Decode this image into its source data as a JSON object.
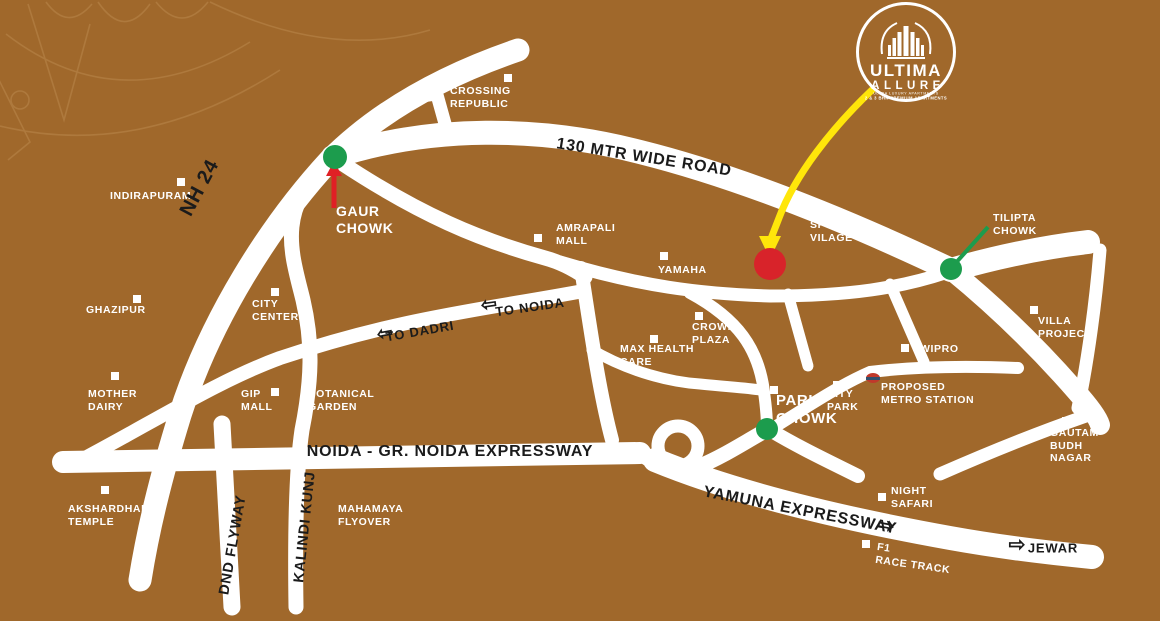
{
  "colors": {
    "background": "#A0682B",
    "road": "#FFFFFF",
    "label_white": "#FFFFFF",
    "label_black": "#1B1B1B",
    "dot_green": "#1C9C4D",
    "dot_red": "#D8232A",
    "pointer_yellow": "#FFE60A",
    "pointer_red": "#E02025"
  },
  "logo": {
    "name": "ULTIMA",
    "sub": "ALLURE",
    "tagline1": "ULTRA LUXURY APARTMENTS",
    "tagline2": "2 & 3 BHK PREMIUM APARTMENTS"
  },
  "landmarks": [
    {
      "id": "crossing-republic",
      "lines": [
        "CROSSING",
        "REPUBLIC"
      ],
      "x": 450,
      "y": 85,
      "marker": {
        "x": 508,
        "y": 78
      }
    },
    {
      "id": "indirapuram",
      "lines": [
        "INDIRAPURAM"
      ],
      "x": 110,
      "y": 190,
      "marker": {
        "x": 181,
        "y": 182
      }
    },
    {
      "id": "gaur-chowk",
      "lines": [
        "GAUR",
        "CHOWK"
      ],
      "x": 336,
      "y": 203,
      "size": 14
    },
    {
      "id": "amrapali-mall",
      "lines": [
        "AMRAPALI",
        "MALL"
      ],
      "x": 556,
      "y": 222,
      "marker": {
        "x": 538,
        "y": 238
      }
    },
    {
      "id": "yamaha",
      "lines": [
        "YAMAHA"
      ],
      "x": 658,
      "y": 264,
      "marker": {
        "x": 664,
        "y": 256
      }
    },
    {
      "id": "sports-vilage",
      "lines": [
        "SPORTS",
        "VILAGE"
      ],
      "x": 810,
      "y": 219,
      "marker": {
        "x": 813,
        "y": 212
      }
    },
    {
      "id": "tilipta-chowk",
      "lines": [
        "TILIPTA",
        "CHOWK"
      ],
      "x": 993,
      "y": 212
    },
    {
      "id": "ghazipur",
      "lines": [
        "GHAZIPUR"
      ],
      "x": 86,
      "y": 304,
      "marker": {
        "x": 137,
        "y": 299
      }
    },
    {
      "id": "city-center",
      "lines": [
        "CITY",
        "CENTER"
      ],
      "x": 252,
      "y": 298,
      "marker": {
        "x": 275,
        "y": 292
      }
    },
    {
      "id": "crown-plaza",
      "lines": [
        "CROWN",
        "PLAZA"
      ],
      "x": 692,
      "y": 321,
      "marker": {
        "x": 699,
        "y": 316
      }
    },
    {
      "id": "max-health-care",
      "lines": [
        "MAX HEALTH",
        "CARE"
      ],
      "x": 620,
      "y": 343,
      "marker": {
        "x": 654,
        "y": 339
      }
    },
    {
      "id": "villa-project",
      "lines": [
        "VILLA",
        "PROJECT"
      ],
      "x": 1038,
      "y": 315,
      "marker": {
        "x": 1034,
        "y": 310
      }
    },
    {
      "id": "wipro",
      "lines": [
        "WIPRO"
      ],
      "x": 920,
      "y": 343,
      "marker": {
        "x": 905,
        "y": 348
      }
    },
    {
      "id": "mother-dairy",
      "lines": [
        "MOTHER",
        "DAIRY"
      ],
      "x": 88,
      "y": 388,
      "marker": {
        "x": 115,
        "y": 376
      }
    },
    {
      "id": "gip-mall",
      "lines": [
        "GIP",
        "MALL"
      ],
      "x": 241,
      "y": 388,
      "marker": {
        "x": 275,
        "y": 392
      }
    },
    {
      "id": "botanical-garden",
      "lines": [
        "BOTANICAL",
        "GARDEN"
      ],
      "x": 308,
      "y": 388
    },
    {
      "id": "pari-chowk",
      "lines": [
        "PARI",
        "CHOWK"
      ],
      "x": 776,
      "y": 392,
      "size": 15,
      "marker": {
        "x": 774,
        "y": 390
      }
    },
    {
      "id": "city-park",
      "lines": [
        "CITY",
        "PARK"
      ],
      "x": 827,
      "y": 388,
      "marker": {
        "x": 837,
        "y": 385
      }
    },
    {
      "id": "proposed-metro-station",
      "lines": [
        "PROPOSED",
        "METRO STATION"
      ],
      "x": 881,
      "y": 381,
      "metro": {
        "x": 873,
        "y": 378
      }
    },
    {
      "id": "gautam-budh-nagar",
      "lines": [
        "GAUTAM",
        "BUDH",
        "NAGAR"
      ],
      "x": 1050,
      "y": 427,
      "marker": {
        "x": 1066,
        "y": 421
      }
    },
    {
      "id": "night-safari",
      "lines": [
        "NIGHT",
        "SAFARI"
      ],
      "x": 891,
      "y": 485,
      "marker": {
        "x": 882,
        "y": 497
      }
    },
    {
      "id": "f1-race-track",
      "lines": [
        "F1",
        "RACE TRACK"
      ],
      "x": 878,
      "y": 541,
      "rotate": 8,
      "marker": {
        "x": 866,
        "y": 544
      }
    },
    {
      "id": "mahamaya-flyover",
      "lines": [
        "MAHAMAYA",
        "FLYOVER"
      ],
      "x": 338,
      "y": 503
    },
    {
      "id": "akshardham-temple",
      "lines": [
        "AKSHARDHAM",
        "TEMPLE"
      ],
      "x": 68,
      "y": 503,
      "marker": {
        "x": 105,
        "y": 490
      }
    }
  ],
  "road_labels": [
    {
      "id": "nh-24",
      "text": "NH 24",
      "x": 200,
      "y": 188,
      "rotate": -62,
      "size": 20
    },
    {
      "id": "130-mtr-wide-road",
      "text": "130 MTR WIDE ROAD",
      "x": 644,
      "y": 158,
      "rotate": 9,
      "size": 16
    },
    {
      "id": "to-noida",
      "text": "TO NOIDA",
      "x": 530,
      "y": 307,
      "rotate": -8,
      "size": 13
    },
    {
      "id": "to-dadri",
      "text": "TO DADRI",
      "x": 420,
      "y": 331,
      "rotate": -10,
      "size": 13
    },
    {
      "id": "noida-gr-noida-expressway",
      "text": "NOIDA - GR. NOIDA EXPRESSWAY",
      "x": 450,
      "y": 452,
      "rotate": 0,
      "size": 16
    },
    {
      "id": "yamuna-expressway",
      "text": "YAMUNA EXPRESSWAY",
      "x": 800,
      "y": 511,
      "rotate": 11,
      "size": 16
    },
    {
      "id": "dnd-flyway",
      "text": "DND FLYWAY",
      "x": 233,
      "y": 545,
      "rotate": -80,
      "size": 14.5
    },
    {
      "id": "kalindi-kunj",
      "text": "KALINDI KUNJ",
      "x": 305,
      "y": 527,
      "rotate": -84,
      "size": 14.5
    },
    {
      "id": "jewar",
      "text": "JEWAR",
      "x": 1053,
      "y": 548,
      "rotate": 0,
      "size": 13
    }
  ],
  "direction_arrows": [
    {
      "id": "to-noida-arrow",
      "glyph": "⇦",
      "x": 489,
      "y": 305,
      "rotate": -8,
      "size": 19
    },
    {
      "id": "to-dadri-arrow",
      "glyph": "⇦",
      "x": 385,
      "y": 334,
      "rotate": -10,
      "size": 19
    },
    {
      "id": "yamuna-arrow",
      "glyph": "⇨",
      "x": 886,
      "y": 526,
      "rotate": 11,
      "size": 20
    },
    {
      "id": "jewar-arrow",
      "glyph": "⇨",
      "x": 1017,
      "y": 545,
      "rotate": 0,
      "size": 20
    }
  ],
  "dots": [
    {
      "id": "project-location-dot",
      "x": 770,
      "y": 264,
      "d": 32,
      "color": "#D8232A"
    },
    {
      "id": "gaur-chowk-dot",
      "x": 335,
      "y": 157,
      "d": 24,
      "color": "#1C9C4D"
    },
    {
      "id": "tilipta-chowk-dot",
      "x": 951,
      "y": 269,
      "d": 22,
      "color": "#1C9C4D"
    },
    {
      "id": "pari-chowk-dot",
      "x": 767,
      "y": 429,
      "d": 22,
      "color": "#1C9C4D"
    }
  ]
}
